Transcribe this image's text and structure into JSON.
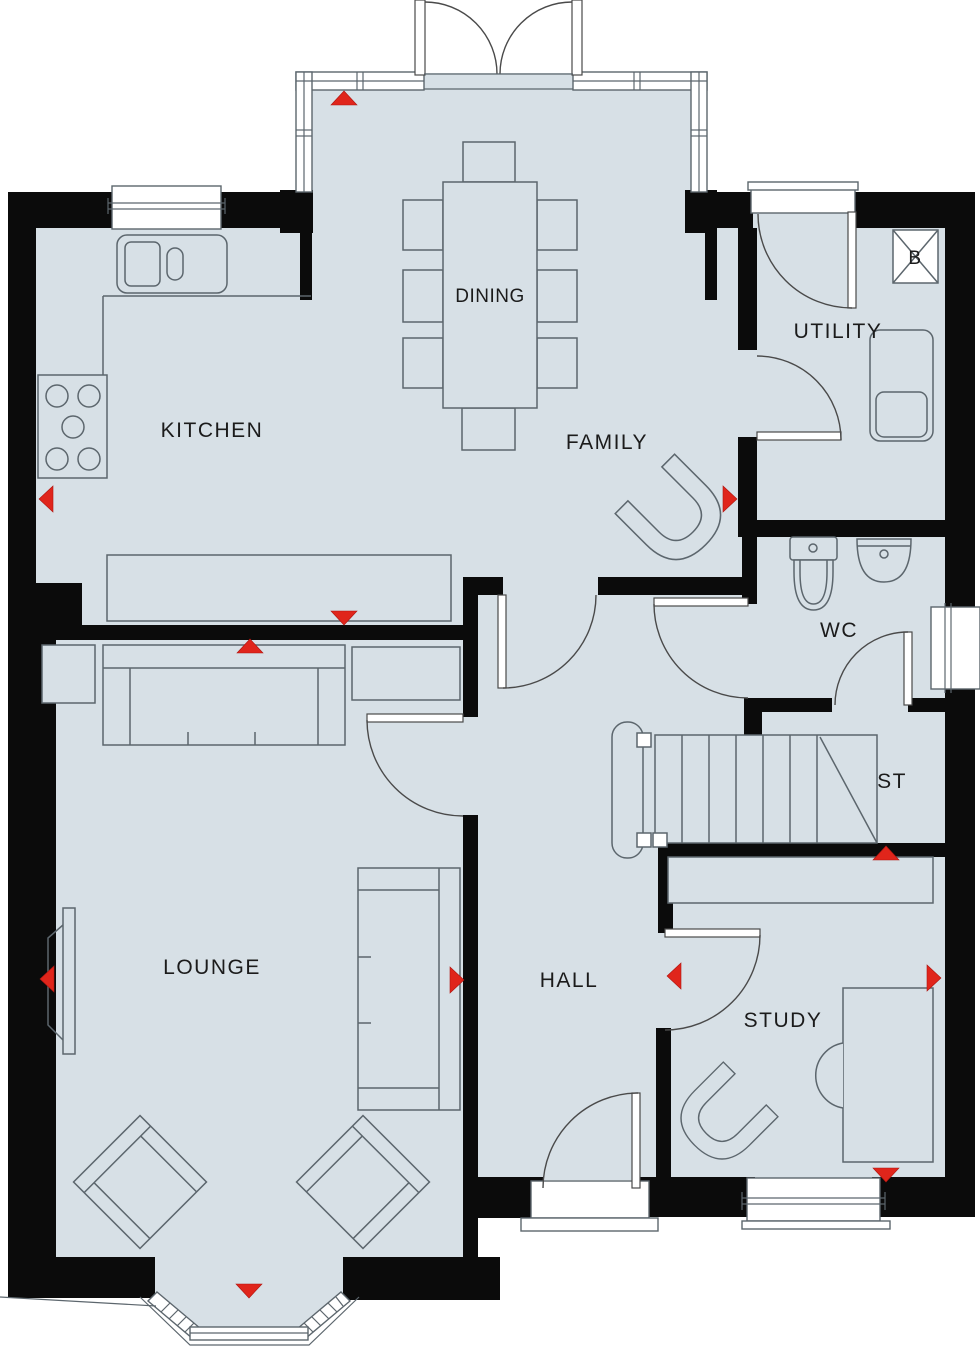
{
  "plan": {
    "type": "ground-floor-plan",
    "rooms": {
      "kitchen": "KITCHEN",
      "dining": "DINING",
      "family": "FAMILY",
      "utility": "UTILITY",
      "wc": "WC",
      "store": "ST",
      "lounge": "LOUNGE",
      "hall": "HALL",
      "study": "STUDY",
      "boiler": "B"
    },
    "colors": {
      "floor": "#d7e0e6",
      "wall": "#0b0b0b",
      "line": "#5c666d",
      "door": "#4a4a4a",
      "accent": "#e0251b",
      "text": "#1b1b1b"
    },
    "radiator_markers": [
      {
        "name": "dining-bay-radiator",
        "dir": "up",
        "x": 344,
        "y": 91
      },
      {
        "name": "kitchen-left-radiator",
        "dir": "left",
        "x": 39,
        "y": 499
      },
      {
        "name": "kitchen-bottom-radiator",
        "dir": "down",
        "x": 344,
        "y": 625
      },
      {
        "name": "lounge-top-radiator",
        "dir": "up",
        "x": 250,
        "y": 639
      },
      {
        "name": "family-right-radiator",
        "dir": "right",
        "x": 737,
        "y": 499
      },
      {
        "name": "stairs-wall-radiator",
        "dir": "up",
        "x": 886,
        "y": 846
      },
      {
        "name": "hall-left-radiator",
        "dir": "left",
        "x": 667,
        "y": 976
      },
      {
        "name": "lounge-right-radiator",
        "dir": "right",
        "x": 464,
        "y": 980
      },
      {
        "name": "study-right-radiator",
        "dir": "right",
        "x": 941,
        "y": 978
      },
      {
        "name": "lounge-wall-radiator",
        "dir": "left",
        "x": 40,
        "y": 979
      },
      {
        "name": "study-window-radiator",
        "dir": "down",
        "x": 886,
        "y": 1182
      },
      {
        "name": "lounge-bay-radiator",
        "dir": "down",
        "x": 249,
        "y": 1298
      }
    ]
  }
}
